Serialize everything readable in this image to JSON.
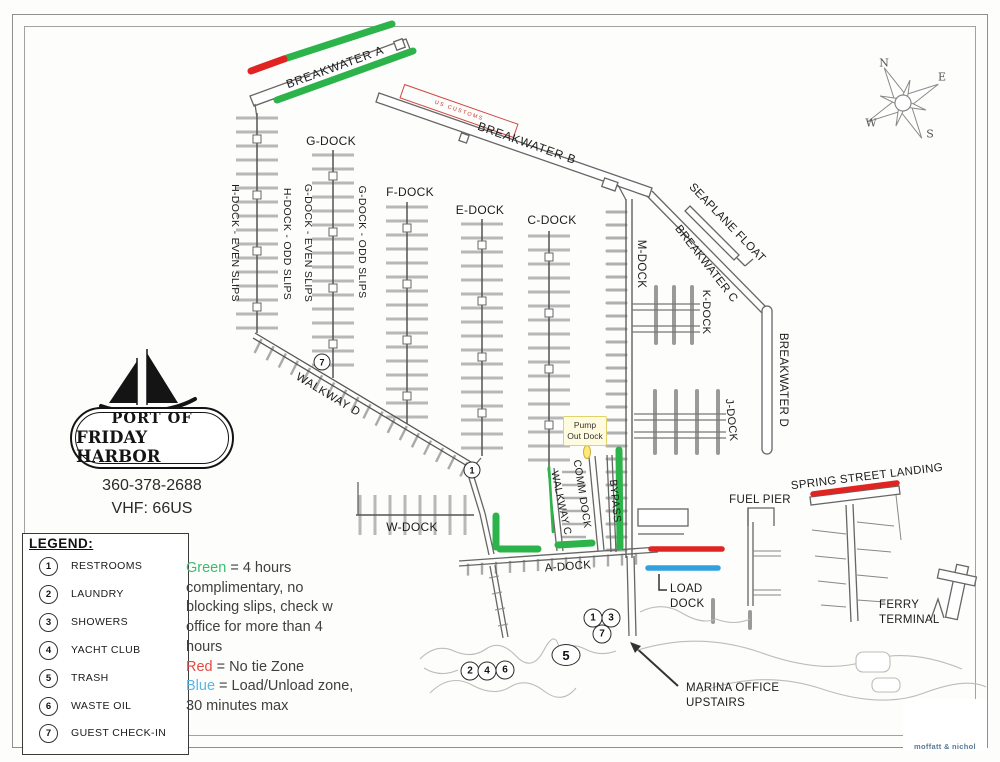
{
  "map": {
    "breakwater_a": "BREAKWATER A",
    "breakwater_b": "BREAKWATER B",
    "breakwater_c": "BREAKWATER C",
    "breakwater_d": "BREAKWATER D",
    "customs": "US CUSTOMS",
    "seaplane_float": "SEAPLANE FLOAT",
    "g_dock": "G-DOCK",
    "h_even": "H-DOCK - EVEN SLIPS",
    "h_odd": "H-DOCK - ODD SLIPS",
    "g_even": "G-DOCK - EVEN SLIPS",
    "g_odd": "G-DOCK - ODD SLIPS",
    "f_dock": "F-DOCK",
    "e_dock": "E-DOCK",
    "c_dock": "C-DOCK",
    "m_dock": "M-DOCK",
    "k_dock": "K-DOCK",
    "j_dock": "J-DOCK",
    "w_dock": "W-DOCK",
    "a_dock": "A-DOCK",
    "walkway_d": "WALKWAY D",
    "walkway_c": "WALKWAY C",
    "comm_dock": "COMM DOCK",
    "bypass": "BYPASS",
    "pump_out_1": "Pump",
    "pump_out_2": "Out Dock",
    "fuel_pier": "FUEL PIER",
    "spring_street_landing": "SPRING STREET LANDING",
    "load_dock_1": "LOAD",
    "load_dock_2": "DOCK",
    "ferry_terminal_1": "FERRY",
    "ferry_terminal_2": "TERMINAL",
    "marina_office_1": "MARINA OFFICE",
    "marina_office_2": "UPSTAIRS"
  },
  "markers": {
    "walkway7": "7",
    "walkway1": "1",
    "b1": "1",
    "b3": "3",
    "b7": "7",
    "b5": "5",
    "b2": "2",
    "b4": "4",
    "b6": "6"
  },
  "compass": {
    "n": "N",
    "e": "E",
    "s": "S",
    "w": "W"
  },
  "logo": {
    "port_line1": "PORT OF",
    "port_line2": "FRIDAY HARBOR",
    "phone": "360-378-2688",
    "vhf": "VHF: 66US"
  },
  "legend": {
    "title": "LEGEND:",
    "items": [
      {
        "num": "1",
        "label": "RESTROOMS"
      },
      {
        "num": "2",
        "label": "LAUNDRY"
      },
      {
        "num": "3",
        "label": "SHOWERS"
      },
      {
        "num": "4",
        "label": "YACHT CLUB"
      },
      {
        "num": "5",
        "label": "TRASH"
      },
      {
        "num": "6",
        "label": "WASTE OIL"
      },
      {
        "num": "7",
        "label": "GUEST CHECK-IN"
      }
    ]
  },
  "notes": {
    "green_word": "Green",
    "green_rest": " = 4 hours",
    "line2": "complimentary, no",
    "line3": "blocking slips, check w",
    "line4": "office for more than 4",
    "line5": "hours",
    "red_word": "Red",
    "red_rest": " = No tie Zone",
    "blue_word": "Blue",
    "blue_rest": " = Load/Unload zone,",
    "line9": "30 minutes max"
  },
  "colors": {
    "zone_green": "#2cb34a",
    "zone_red": "#e02421",
    "zone_blue": "#32a1dd",
    "note_green": "#3dbb6e",
    "note_red": "#e04b45",
    "note_blue": "#5ab6e8",
    "brand_blue": "#567a96"
  },
  "brand": {
    "name": "moffatt & nichol"
  }
}
